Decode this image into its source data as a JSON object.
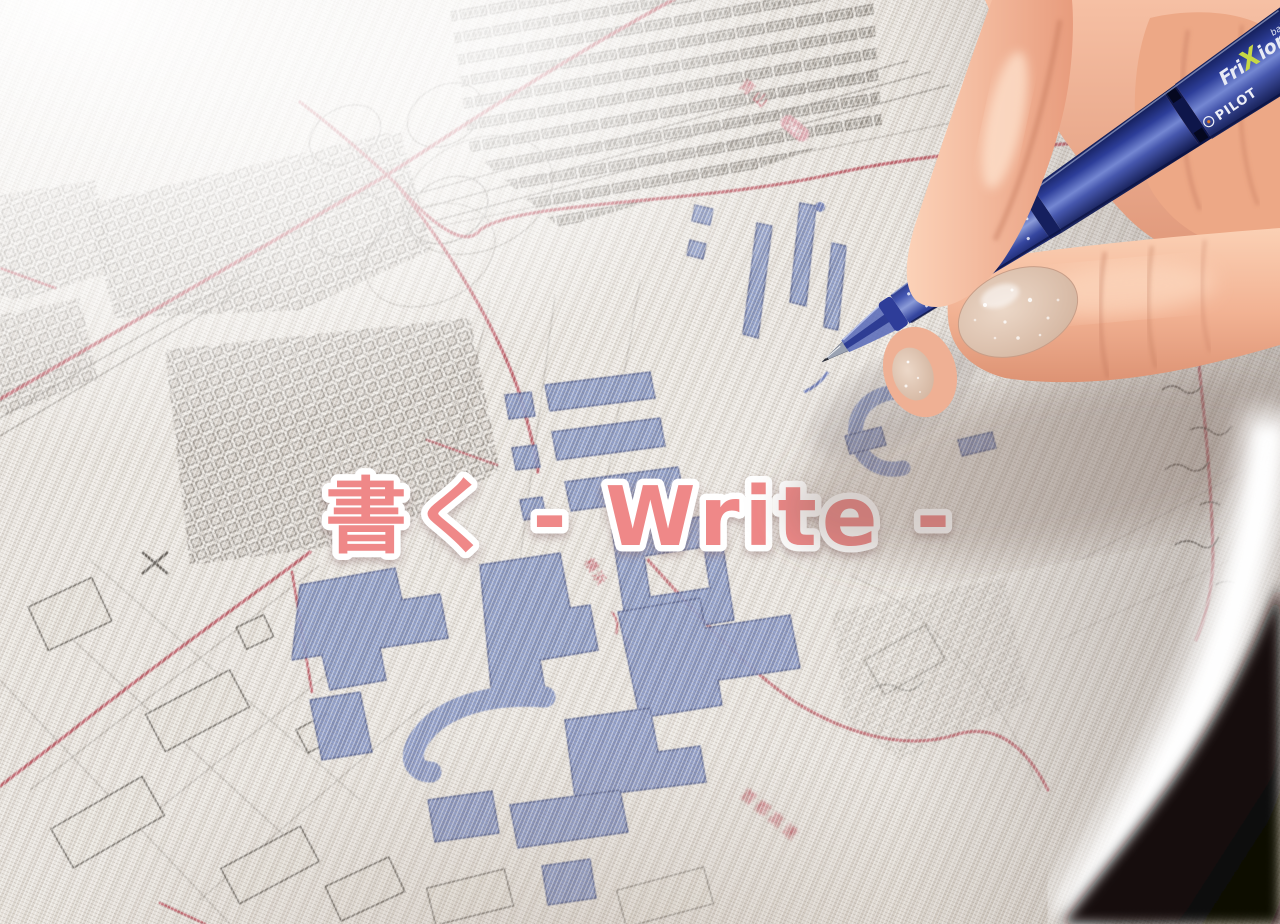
{
  "overlay": {
    "title": "書く - Write -",
    "color": "#ef8888",
    "outline": "#ffffff"
  },
  "pen": {
    "brand": "PILOT",
    "model_fri": "Fri",
    "model_x": "X",
    "model_ion": "ion",
    "model_sub": "ball",
    "body_color": "#2c3d95"
  },
  "map": {
    "fabric_color": "#ece8e2",
    "ink_color": "#7d8ec4",
    "road_color": "#c24b58",
    "line_color": "#6c665f",
    "labels": {
      "route_area": "青山",
      "route_shield": "246",
      "district": "横浜",
      "highway": "首都高速"
    }
  }
}
